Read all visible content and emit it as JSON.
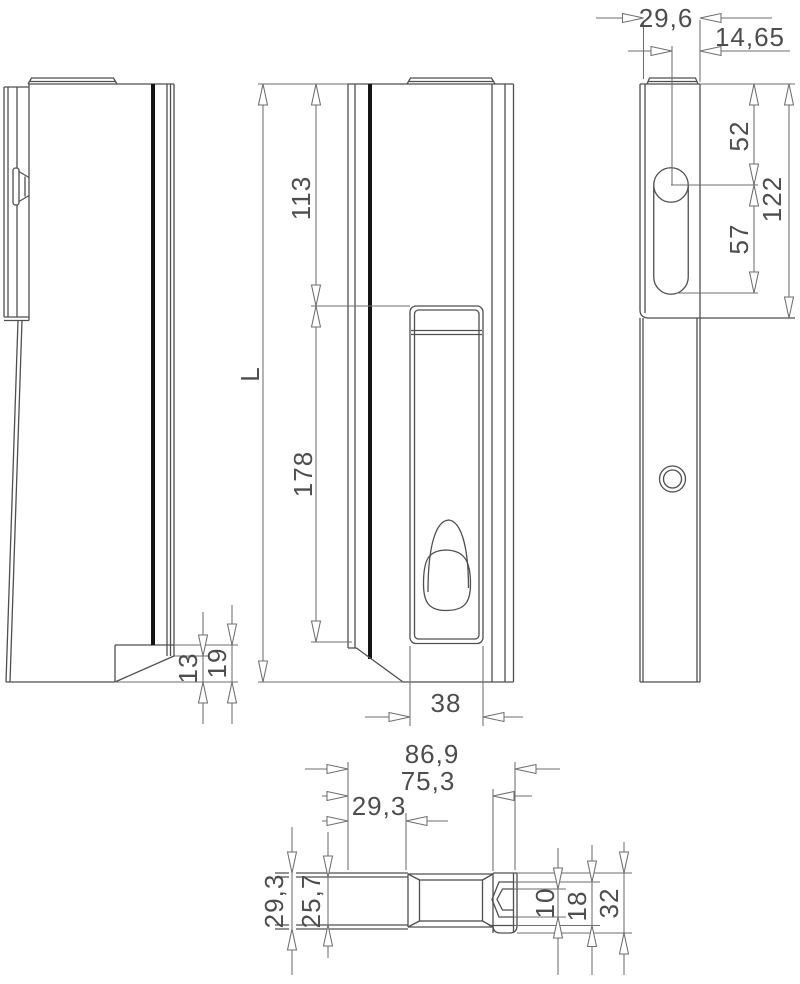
{
  "drawing": {
    "type": "technical-orthographic-drawing",
    "background": "#ffffff",
    "line_color": "#4f4f4f",
    "accent_black": "#141414",
    "views": {
      "left_side": {
        "dims": {
          "chamfer_height": "13",
          "foot_height": "19"
        }
      },
      "front": {
        "dims": {
          "total_length": "L",
          "top_to_handle": "113",
          "handle_length": "178",
          "handle_width": "38"
        }
      },
      "right_side": {
        "dims": {
          "body_width": "29,6",
          "hole_to_edge": "14,65",
          "top_to_hole": "52",
          "hole_to_slot_end": "57",
          "top_to_slot_bottom": "122"
        }
      },
      "plan": {
        "dims": {
          "overall_depth": "86,9",
          "to_faceplate": "75,3",
          "housing_depth": "29,3",
          "housing_width": "29,3",
          "inner_width": "25,7",
          "hook_slot": "10",
          "hook_width": "18",
          "faceplate_width": "32"
        }
      }
    }
  }
}
